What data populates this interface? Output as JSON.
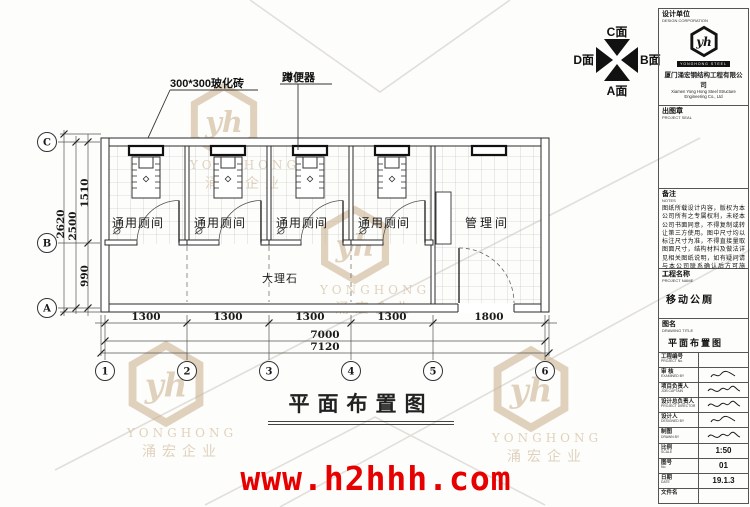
{
  "brand": {
    "monogram": "yh",
    "watermark_name": "YONGHONG",
    "watermark_cn": "涌宏企业",
    "watermark_color": "#c9ae8c"
  },
  "page": {
    "url": "www.h2hhh.com",
    "url_color": "#e60000"
  },
  "compass": {
    "top": "C面",
    "bottom": "A面",
    "left": "D面",
    "right": "B面"
  },
  "plan": {
    "callout_tile": "300*300玻化砖",
    "callout_toilet": "蹲便器",
    "label_marble": "大理石",
    "stalls": [
      {
        "label": "通用厕间"
      },
      {
        "label": "通用厕间"
      },
      {
        "label": "通用厕间"
      },
      {
        "label": "通用厕间"
      }
    ],
    "room_right": "管理间",
    "grid_cols": [
      "1",
      "2",
      "3",
      "4",
      "5",
      "6"
    ],
    "grid_rows": [
      "C",
      "B",
      "A"
    ],
    "dims": {
      "bays": [
        "1300",
        "1300",
        "1300",
        "1300",
        "1800"
      ],
      "total": "7000",
      "overall": "7120",
      "left_upper": "1510",
      "left_lower": "990",
      "left_total": "2500",
      "left_overall": "2620"
    }
  },
  "drawing_title": "平面布置图",
  "titleblock": {
    "design_unit": {
      "label": "设计单位",
      "sub": "DESIGN CORPORATION"
    },
    "logo": {
      "banner": "YONGHONG STEEL",
      "company_cn": "厦门涌宏钢结构工程有限公司",
      "company_en1": "Xiamen Yong Hong Steel Structure",
      "company_en2": "Engineering Co., Ltd"
    },
    "seal": {
      "label": "出图章",
      "sub": "PROJECT SEAL"
    },
    "notes": {
      "label": "备注",
      "sub": "NOTES",
      "text": "图纸所载设计内容，版权为本公司所有之专属权利，未经本公司书面同意，不得复制或转让第三方使用。图中尺寸均以标注尺寸为准，不得直接量取图面尺寸，结构材料及做法详见相关图纸说明，如有疑问请与本公司联系确认后方可施工。"
    },
    "project": {
      "label": "工程名称",
      "sub": "PROJECT NAME",
      "value": "移动公厕"
    },
    "drawing": {
      "label": "图名",
      "sub": "DRAWING TITLE",
      "value": "平面布置图"
    },
    "rows": [
      {
        "label": "工程编号",
        "sub": "PROJECT No.",
        "value": ""
      },
      {
        "label": "审 核",
        "sub": "EXAMINED BY",
        "value": ""
      },
      {
        "label": "项目负责人",
        "sub": "JOB CAPTAIN",
        "value": ""
      },
      {
        "label": "设计总负责人",
        "sub": "PROJECT DIRECTOR",
        "value": ""
      },
      {
        "label": "设计人",
        "sub": "DESIGNED BY",
        "value": ""
      },
      {
        "label": "制图",
        "sub": "DRAWN BY",
        "value": ""
      },
      {
        "label": "比例",
        "sub": "SCALE",
        "value": "1:50"
      },
      {
        "label": "图号",
        "sub": "No.",
        "value": "01"
      },
      {
        "label": "日期",
        "sub": "DATE",
        "value": "19.1.3"
      },
      {
        "label": "文件名",
        "sub": "",
        "value": ""
      }
    ]
  }
}
